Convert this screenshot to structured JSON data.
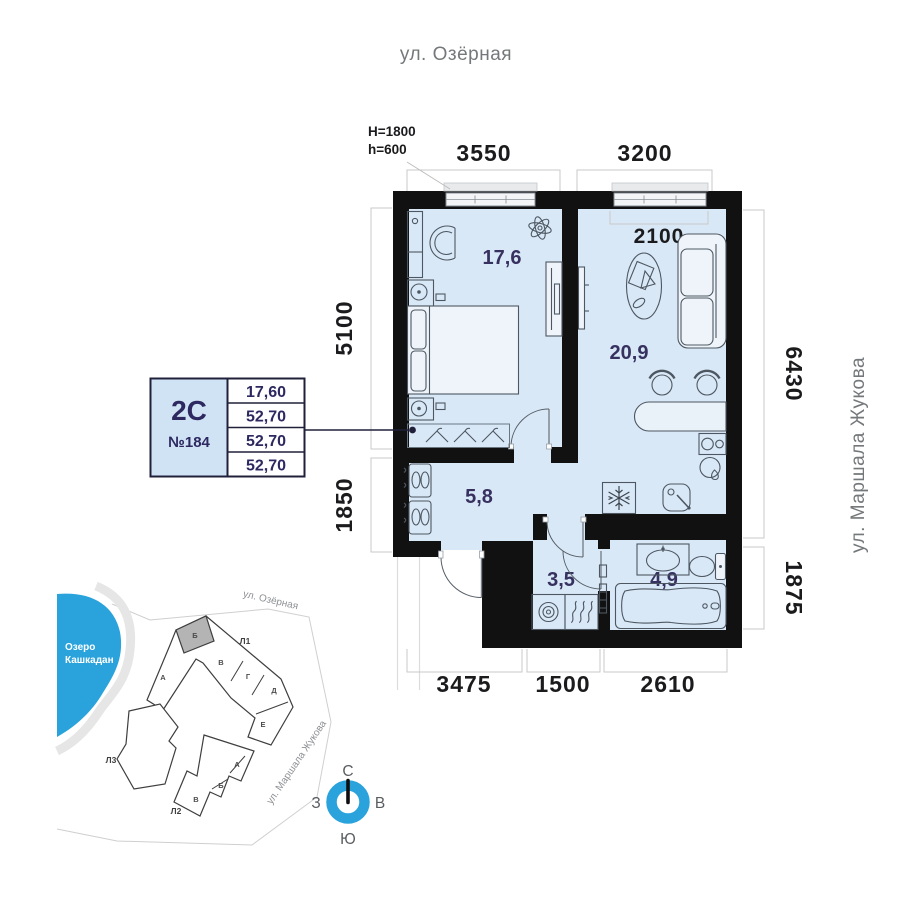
{
  "streets": {
    "top": "ул. Озёрная",
    "right": "ул. Маршала Жукова"
  },
  "plan": {
    "window_note": {
      "line1": "H=1800",
      "line2": "h=600"
    },
    "dims": {
      "top": [
        "3550",
        "3200"
      ],
      "inner_top": "2100",
      "left": [
        "5100",
        "1850"
      ],
      "right": [
        "6430",
        "1875"
      ],
      "bottom": [
        "3475",
        "1500",
        "2610"
      ]
    },
    "rooms": {
      "bedroom": "17,6",
      "living": "20,9",
      "hall": "5,8",
      "laundry": "3,5",
      "bath": "4,9"
    }
  },
  "info_card": {
    "plan_type": "2С",
    "apartment_number": "№184",
    "rows": [
      "17,60",
      "52,70",
      "52,70",
      "52,70"
    ]
  },
  "minimap": {
    "lake_line1": "Озеро",
    "lake_line2": "Кашкадан",
    "street_top": "ул. Озёрная",
    "street_right": "ул. Маршала Жукова",
    "l1": {
      "label": "Л1",
      "sections": [
        "А",
        "Б",
        "В",
        "Г",
        "Д",
        "Е"
      ],
      "highlighted": "Б"
    },
    "l2": {
      "label": "Л2",
      "sections": [
        "А",
        "Б",
        "В"
      ]
    },
    "l3": {
      "label": "Л3"
    }
  },
  "compass": {
    "north": "С",
    "south": "Ю",
    "west": "З",
    "east": "В"
  },
  "colors": {
    "wall": "#111111",
    "room_fill": "#d9e8f7",
    "accent_navy": "#2d2960",
    "dim_text": "#1b1b1d",
    "lake_blue": "#2aa3dc",
    "compass_blue": "#2aa3dc",
    "highlight_gray": "#b4b4b4",
    "card_fill": "#cfe3f5"
  }
}
